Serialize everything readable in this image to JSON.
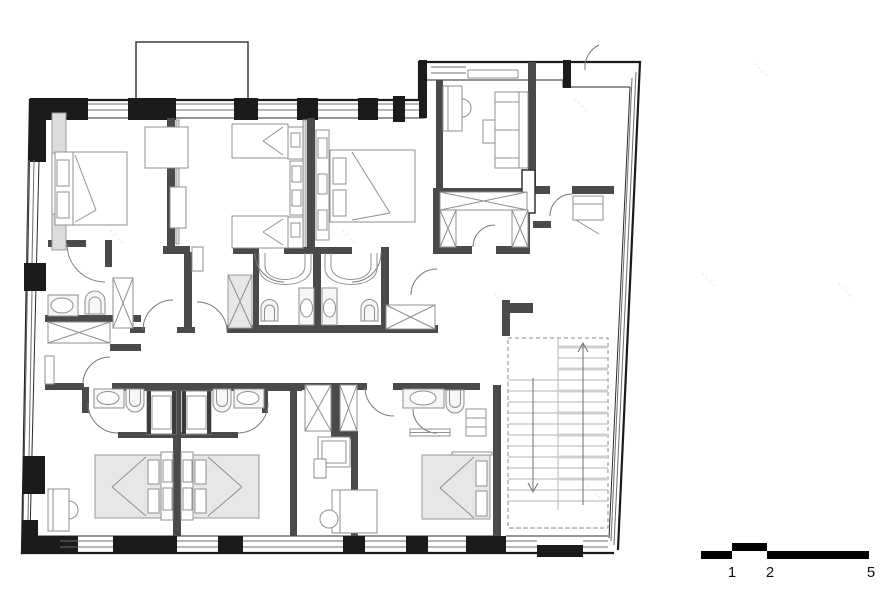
{
  "page": {
    "background": "#ffffff",
    "description": "black-and-white architectural floor plan of an apartment level with bedrooms, bathrooms, corridor and a double-run staircase"
  },
  "scale_bar": {
    "labels": [
      "1",
      "2",
      "5"
    ]
  },
  "watermark": {
    "glyph": "▪▪▪▪"
  },
  "colors": {
    "exterior_wall": "#1b1b1b",
    "interior_wall": "#4a4a4a",
    "furniture_line": "#8f8f8f",
    "bed_fill": "#e7e7e7",
    "window_line": "#6e6e6e",
    "stair_tread": "#b3b3b3",
    "scale_bar": "#000000"
  },
  "plan": {
    "rooms": [
      "bedroom-top-left",
      "bedroom-top-middle-left",
      "bedroom-top-middle-right",
      "lounge-top-right",
      "entry-hall",
      "closet-vestibule",
      "bathroom-left",
      "bathroom-central-left",
      "bathroom-central-right",
      "corridor",
      "stairwell",
      "bedroom-bottom-left",
      "bedroom-bottom-center",
      "study-bottom-middle",
      "bedroom-bottom-right",
      "bathroom-bottom-left",
      "bathroom-bottom-right",
      "bathroom-bottom-middle"
    ],
    "fixtures": {
      "double_beds": 4,
      "single_beds": 3,
      "toilets": 6,
      "sinks": 7,
      "showers": 4,
      "x_wardrobes": 9,
      "sofas": 1,
      "desks": 5,
      "balconies": 1
    },
    "stairs": {
      "runs": 2,
      "up_arrow": true,
      "down_arrow": true
    }
  }
}
